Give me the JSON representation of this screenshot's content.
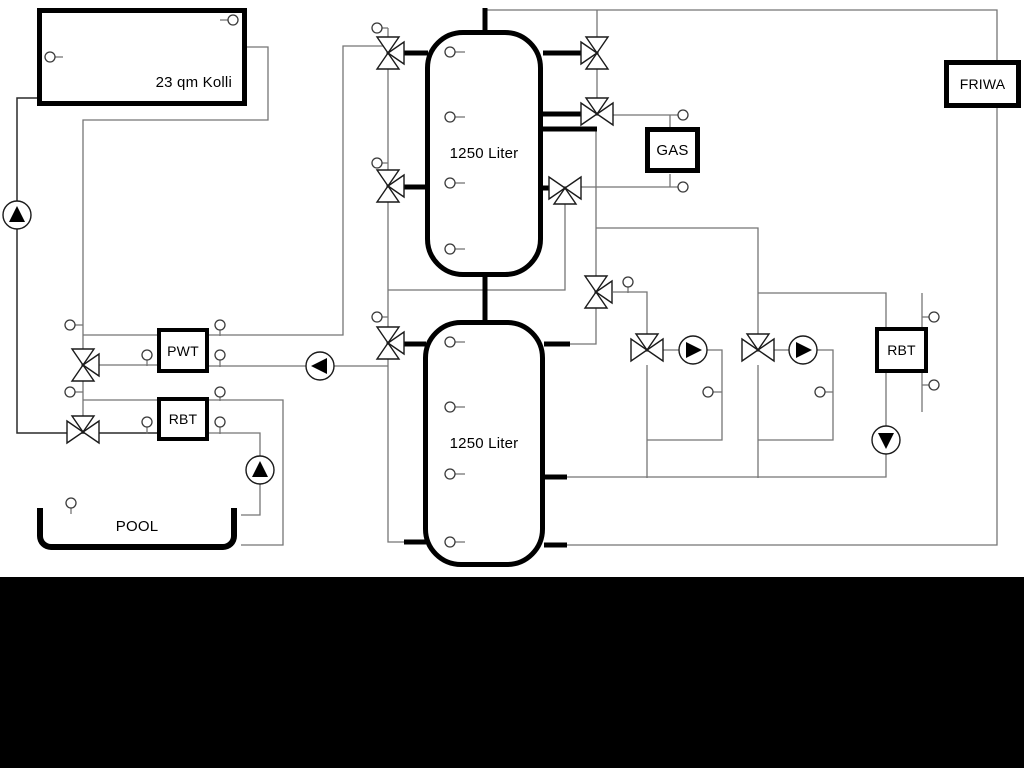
{
  "labels": {
    "collector": "23 qm Kolli",
    "tank_top": "1250 Liter",
    "tank_bottom": "1250 Liter",
    "pwt": "PWT",
    "rbt_left": "RBT",
    "gas": "GAS",
    "friwa": "FRIWA",
    "rbt_right": "RBT",
    "pool": "POOL"
  },
  "colors": {
    "pipe": "#757575",
    "pipe_dark": "#2a2a2a",
    "thick_pipe": "#000000",
    "background": "#ffffff",
    "band": "#000000",
    "symbol_fill": "#ffffff",
    "symbol_stroke": "#1a1a1a"
  },
  "diagram": {
    "thin_lines": [
      [
        [
          247,
          47
        ],
        [
          268,
          47
        ],
        [
          268,
          120
        ],
        [
          83,
          120
        ],
        [
          83,
          417
        ]
      ],
      [
        [
          83,
          335
        ],
        [
          157,
          335
        ]
      ],
      [
        [
          209,
          335
        ],
        [
          343,
          335
        ],
        [
          343,
          46
        ],
        [
          388,
          46
        ],
        [
          388,
          366
        ]
      ],
      [
        [
          388,
          290
        ],
        [
          565,
          290
        ],
        [
          565,
          203
        ]
      ],
      [
        [
          98,
          365
        ],
        [
          157,
          365
        ]
      ],
      [
        [
          209,
          366
        ],
        [
          388,
          366
        ]
      ],
      [
        [
          388,
          366
        ],
        [
          388,
          542
        ],
        [
          405,
          542
        ]
      ],
      [
        [
          83,
          400
        ],
        [
          157,
          400
        ]
      ],
      [
        [
          209,
          400
        ],
        [
          283,
          400
        ],
        [
          283,
          545
        ],
        [
          241,
          545
        ]
      ],
      [
        [
          209,
          433
        ],
        [
          260,
          433
        ],
        [
          260,
          515
        ],
        [
          241,
          515
        ]
      ],
      [
        [
          485,
          10
        ],
        [
          997,
          10
        ],
        [
          997,
          60
        ]
      ],
      [
        [
          997,
          108
        ],
        [
          997,
          545
        ],
        [
          566,
          545
        ]
      ],
      [
        [
          597,
          10
        ],
        [
          597,
          98
        ]
      ],
      [
        [
          613,
          115
        ],
        [
          678,
          115
        ]
      ],
      [
        [
          670,
          115
        ],
        [
          670,
          128
        ]
      ],
      [
        [
          581,
          187
        ],
        [
          678,
          187
        ]
      ],
      [
        [
          670,
          187
        ],
        [
          670,
          174
        ]
      ],
      [
        [
          596,
          129
        ],
        [
          596,
          344
        ],
        [
          570,
          344
        ]
      ],
      [
        [
          596,
          228
        ],
        [
          758,
          228
        ],
        [
          758,
          335
        ]
      ],
      [
        [
          758,
          293
        ],
        [
          886,
          293
        ],
        [
          886,
          327
        ]
      ],
      [
        [
          613,
          292
        ],
        [
          647,
          292
        ],
        [
          647,
          335
        ]
      ],
      [
        [
          647,
          365
        ],
        [
          647,
          478
        ]
      ],
      [
        [
          663,
          350
        ],
        [
          680,
          350
        ]
      ],
      [
        [
          706,
          350
        ],
        [
          722,
          350
        ],
        [
          722,
          440
        ],
        [
          647,
          440
        ]
      ],
      [
        [
          774,
          350
        ],
        [
          790,
          350
        ]
      ],
      [
        [
          816,
          350
        ],
        [
          833,
          350
        ],
        [
          833,
          440
        ],
        [
          758,
          440
        ]
      ],
      [
        [
          758,
          365
        ],
        [
          758,
          478
        ]
      ],
      [
        [
          566,
          477
        ],
        [
          886,
          477
        ],
        [
          886,
          373
        ]
      ],
      [
        [
          922,
          293
        ],
        [
          922,
          328
        ]
      ],
      [
        [
          922,
          372
        ],
        [
          922,
          412
        ]
      ],
      [
        [
          388,
          28
        ],
        [
          388,
          46
        ]
      ]
    ],
    "dark_lines": [
      [
        [
          37,
          98
        ],
        [
          17,
          98
        ],
        [
          17,
          433
        ],
        [
          157,
          433
        ]
      ]
    ],
    "thick_lines": [
      [
        [
          404,
          53
        ],
        [
          428,
          53
        ]
      ],
      [
        [
          404,
          187
        ],
        [
          428,
          187
        ]
      ],
      [
        [
          485,
          8
        ],
        [
          485,
          33
        ]
      ],
      [
        [
          543,
          53
        ],
        [
          582,
          53
        ]
      ],
      [
        [
          543,
          114
        ],
        [
          582,
          114
        ]
      ],
      [
        [
          543,
          129
        ],
        [
          597,
          129
        ]
      ],
      [
        [
          543,
          188
        ],
        [
          551,
          188
        ]
      ],
      [
        [
          485,
          274
        ],
        [
          485,
          323
        ]
      ],
      [
        [
          404,
          344
        ],
        [
          426,
          344
        ]
      ],
      [
        [
          404,
          542
        ],
        [
          426,
          542
        ]
      ],
      [
        [
          544,
          344
        ],
        [
          570,
          344
        ]
      ],
      [
        [
          544,
          477
        ],
        [
          567,
          477
        ]
      ],
      [
        [
          544,
          545
        ],
        [
          567,
          545
        ]
      ]
    ],
    "valves": [
      {
        "x": 83,
        "y": 365,
        "o": "v",
        "b": "r"
      },
      {
        "x": 83,
        "y": 432,
        "o": "h",
        "b": "t"
      },
      {
        "x": 388,
        "y": 53,
        "o": "v",
        "b": "r"
      },
      {
        "x": 388,
        "y": 186,
        "o": "v",
        "b": "r"
      },
      {
        "x": 388,
        "y": 343,
        "o": "v",
        "b": "r"
      },
      {
        "x": 597,
        "y": 53,
        "o": "v",
        "b": "l"
      },
      {
        "x": 597,
        "y": 114,
        "o": "h",
        "b": "t"
      },
      {
        "x": 565,
        "y": 188,
        "o": "h",
        "b": "b"
      },
      {
        "x": 596,
        "y": 292,
        "o": "v",
        "b": "r"
      },
      {
        "x": 647,
        "y": 350,
        "o": "h",
        "b": "t"
      },
      {
        "x": 758,
        "y": 350,
        "o": "h",
        "b": "t"
      }
    ],
    "pumps": [
      {
        "x": 17,
        "y": 215,
        "d": "up"
      },
      {
        "x": 320,
        "y": 366,
        "d": "left"
      },
      {
        "x": 260,
        "y": 470,
        "d": "up"
      },
      {
        "x": 693,
        "y": 350,
        "d": "right"
      },
      {
        "x": 803,
        "y": 350,
        "d": "right"
      },
      {
        "x": 886,
        "y": 440,
        "d": "down"
      }
    ],
    "sensors": [
      {
        "x": 233,
        "y": 20,
        "s": "l",
        "len": 8
      },
      {
        "x": 50,
        "y": 57,
        "s": "r",
        "len": 8
      },
      {
        "x": 70,
        "y": 325,
        "s": "r",
        "len": 8
      },
      {
        "x": 70,
        "y": 392,
        "s": "r",
        "len": 8
      },
      {
        "x": 147,
        "y": 355,
        "s": "d",
        "len": 6
      },
      {
        "x": 220,
        "y": 325,
        "s": "d",
        "len": 6
      },
      {
        "x": 220,
        "y": 355,
        "s": "d",
        "len": 7
      },
      {
        "x": 147,
        "y": 422,
        "s": "d",
        "len": 7
      },
      {
        "x": 220,
        "y": 392,
        "s": "d",
        "len": 4
      },
      {
        "x": 220,
        "y": 422,
        "s": "d",
        "len": 7
      },
      {
        "x": 71,
        "y": 503,
        "s": "d",
        "len": 6
      },
      {
        "x": 377,
        "y": 28,
        "s": "r",
        "len": 6
      },
      {
        "x": 377,
        "y": 163,
        "s": "r",
        "len": 6
      },
      {
        "x": 377,
        "y": 317,
        "s": "r",
        "len": 6
      },
      {
        "x": 628,
        "y": 282,
        "s": "d",
        "len": 6
      },
      {
        "x": 683,
        "y": 115,
        "s": "n",
        "len": 0
      },
      {
        "x": 683,
        "y": 187,
        "s": "n",
        "len": 0
      },
      {
        "x": 708,
        "y": 392,
        "s": "r",
        "len": 9
      },
      {
        "x": 820,
        "y": 392,
        "s": "r",
        "len": 8
      },
      {
        "x": 934,
        "y": 317,
        "s": "l",
        "len": 7
      },
      {
        "x": 934,
        "y": 385,
        "s": "l",
        "len": 7
      },
      {
        "x": 450,
        "y": 52,
        "s": "r",
        "len": 10
      },
      {
        "x": 450,
        "y": 117,
        "s": "r",
        "len": 10
      },
      {
        "x": 450,
        "y": 183,
        "s": "r",
        "len": 10
      },
      {
        "x": 450,
        "y": 249,
        "s": "r",
        "len": 10
      },
      {
        "x": 450,
        "y": 342,
        "s": "r",
        "len": 10
      },
      {
        "x": 450,
        "y": 407,
        "s": "r",
        "len": 10
      },
      {
        "x": 450,
        "y": 474,
        "s": "r",
        "len": 10
      },
      {
        "x": 450,
        "y": 542,
        "s": "r",
        "len": 10
      }
    ]
  }
}
